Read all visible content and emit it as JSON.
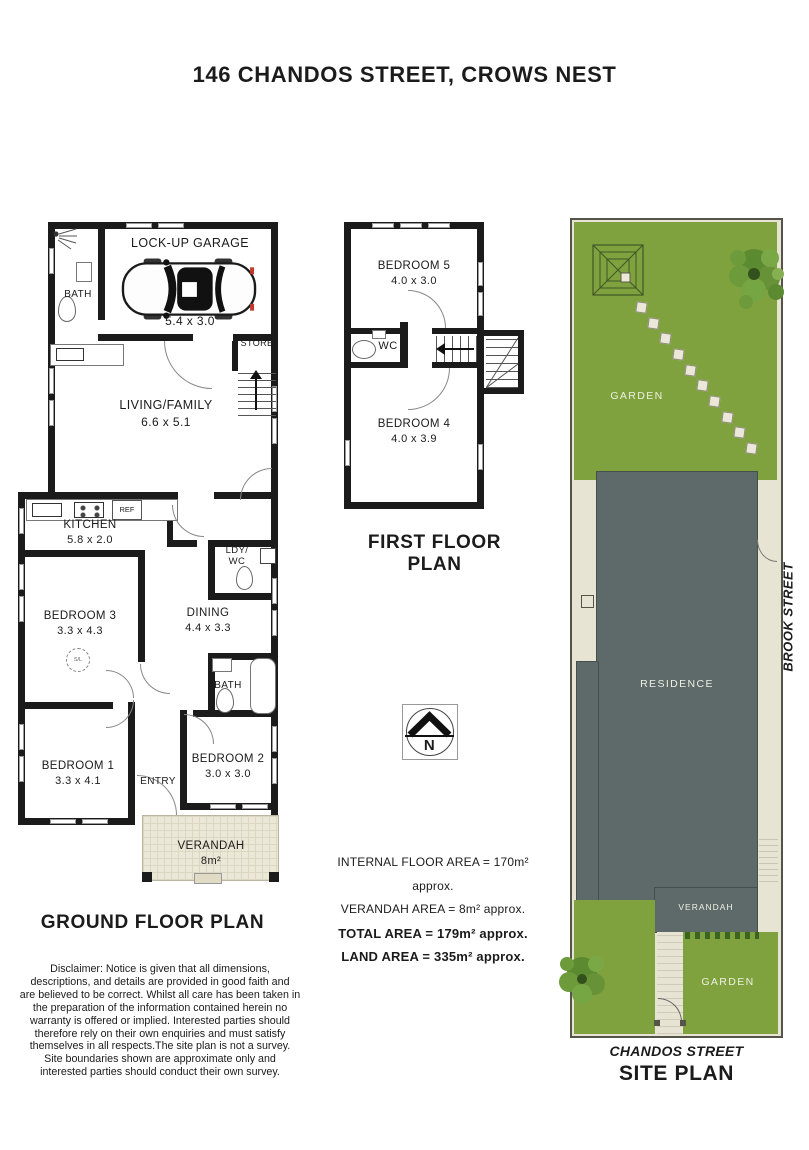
{
  "title": "146 CHANDOS STREET, CROWS NEST",
  "colors": {
    "garden_green": "#7fa23e",
    "residence_grey": "#5e696a",
    "path_beige": "#e8e4d3",
    "wall_black": "#1b1b1b"
  },
  "ground_floor": {
    "label": "GROUND FLOOR PLAN",
    "garage": {
      "name": "LOCK-UP GARAGE",
      "dims": "5.4 x 3.0"
    },
    "bath_upper": "BATH",
    "store": "STORE",
    "living": {
      "name": "LIVING/FAMILY",
      "dims": "6.6 x 5.1"
    },
    "kitchen": {
      "name": "KITCHEN",
      "dims": "5.8 x 2.0"
    },
    "ref": "REF",
    "ldy_wc": "LDY/\nWC",
    "bedroom3": {
      "name": "BEDROOM 3",
      "dims": "3.3 x 4.3"
    },
    "sl": "S/L",
    "dining": {
      "name": "DINING",
      "dims": "4.4 x 3.3"
    },
    "bath_lower": "BATH",
    "bedroom1": {
      "name": "BEDROOM 1",
      "dims": "3.3 x 4.1"
    },
    "entry": "ENTRY",
    "bedroom2": {
      "name": "BEDROOM 2",
      "dims": "3.0 x 3.0"
    },
    "verandah": {
      "name": "VERANDAH",
      "dims": "8m²"
    }
  },
  "first_floor": {
    "label": "FIRST FLOOR PLAN",
    "bedroom5": {
      "name": "BEDROOM 5",
      "dims": "4.0 x 3.0"
    },
    "wc": "WC",
    "bedroom4": {
      "name": "BEDROOM 4",
      "dims": "4.0 x 3.9"
    }
  },
  "compass": {
    "north": "N"
  },
  "areas": [
    {
      "text": "INTERNAL FLOOR AREA = 170m² approx.",
      "bold": false
    },
    {
      "text": "VERANDAH AREA = 8m² approx.",
      "bold": false
    },
    {
      "text": "TOTAL AREA = 179m² approx.",
      "bold": true
    },
    {
      "text": "LAND AREA = 335m² approx.",
      "bold": true
    }
  ],
  "disclaimer": "Disclaimer: Notice is given that all dimensions,\ndescriptions, and details are provided in good faith and\nare believed to be correct. Whilst all care has been taken in\nthe preparation of the information contained herein no\nwarranty is offered or implied. Interested parties should\ntherefore rely on their own enquiries and must satisfy\nthemselves in all respects.The site plan is not a survey.\nSite boundaries shown are approximate only and\ninterested parties should conduct their own survey.",
  "site_plan": {
    "label": "SITE PLAN",
    "garden_top": "GARDEN",
    "garden_bottom": "GARDEN",
    "residence": "RESIDENCE",
    "verandah": "VERANDAH",
    "street_side": "BROOK STREET",
    "street_front": "CHANDOS STREET"
  }
}
